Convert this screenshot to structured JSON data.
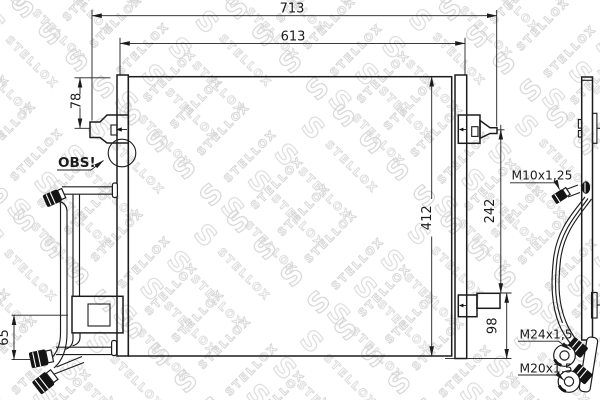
{
  "watermark": {
    "brand": "STELLOX",
    "letter": "S"
  },
  "drawing": {
    "dimensions": {
      "overall_width": "713",
      "core_width": "613",
      "inlet_offset": "78",
      "core_height": "412",
      "port_span": "242",
      "bottom_offset": "98",
      "left_port_span": "65"
    },
    "labels": {
      "attention": "OBS!",
      "thread_upper": "M10x1,25",
      "thread_middle": "M24x1,5",
      "thread_lower": "M20x1,5"
    }
  }
}
